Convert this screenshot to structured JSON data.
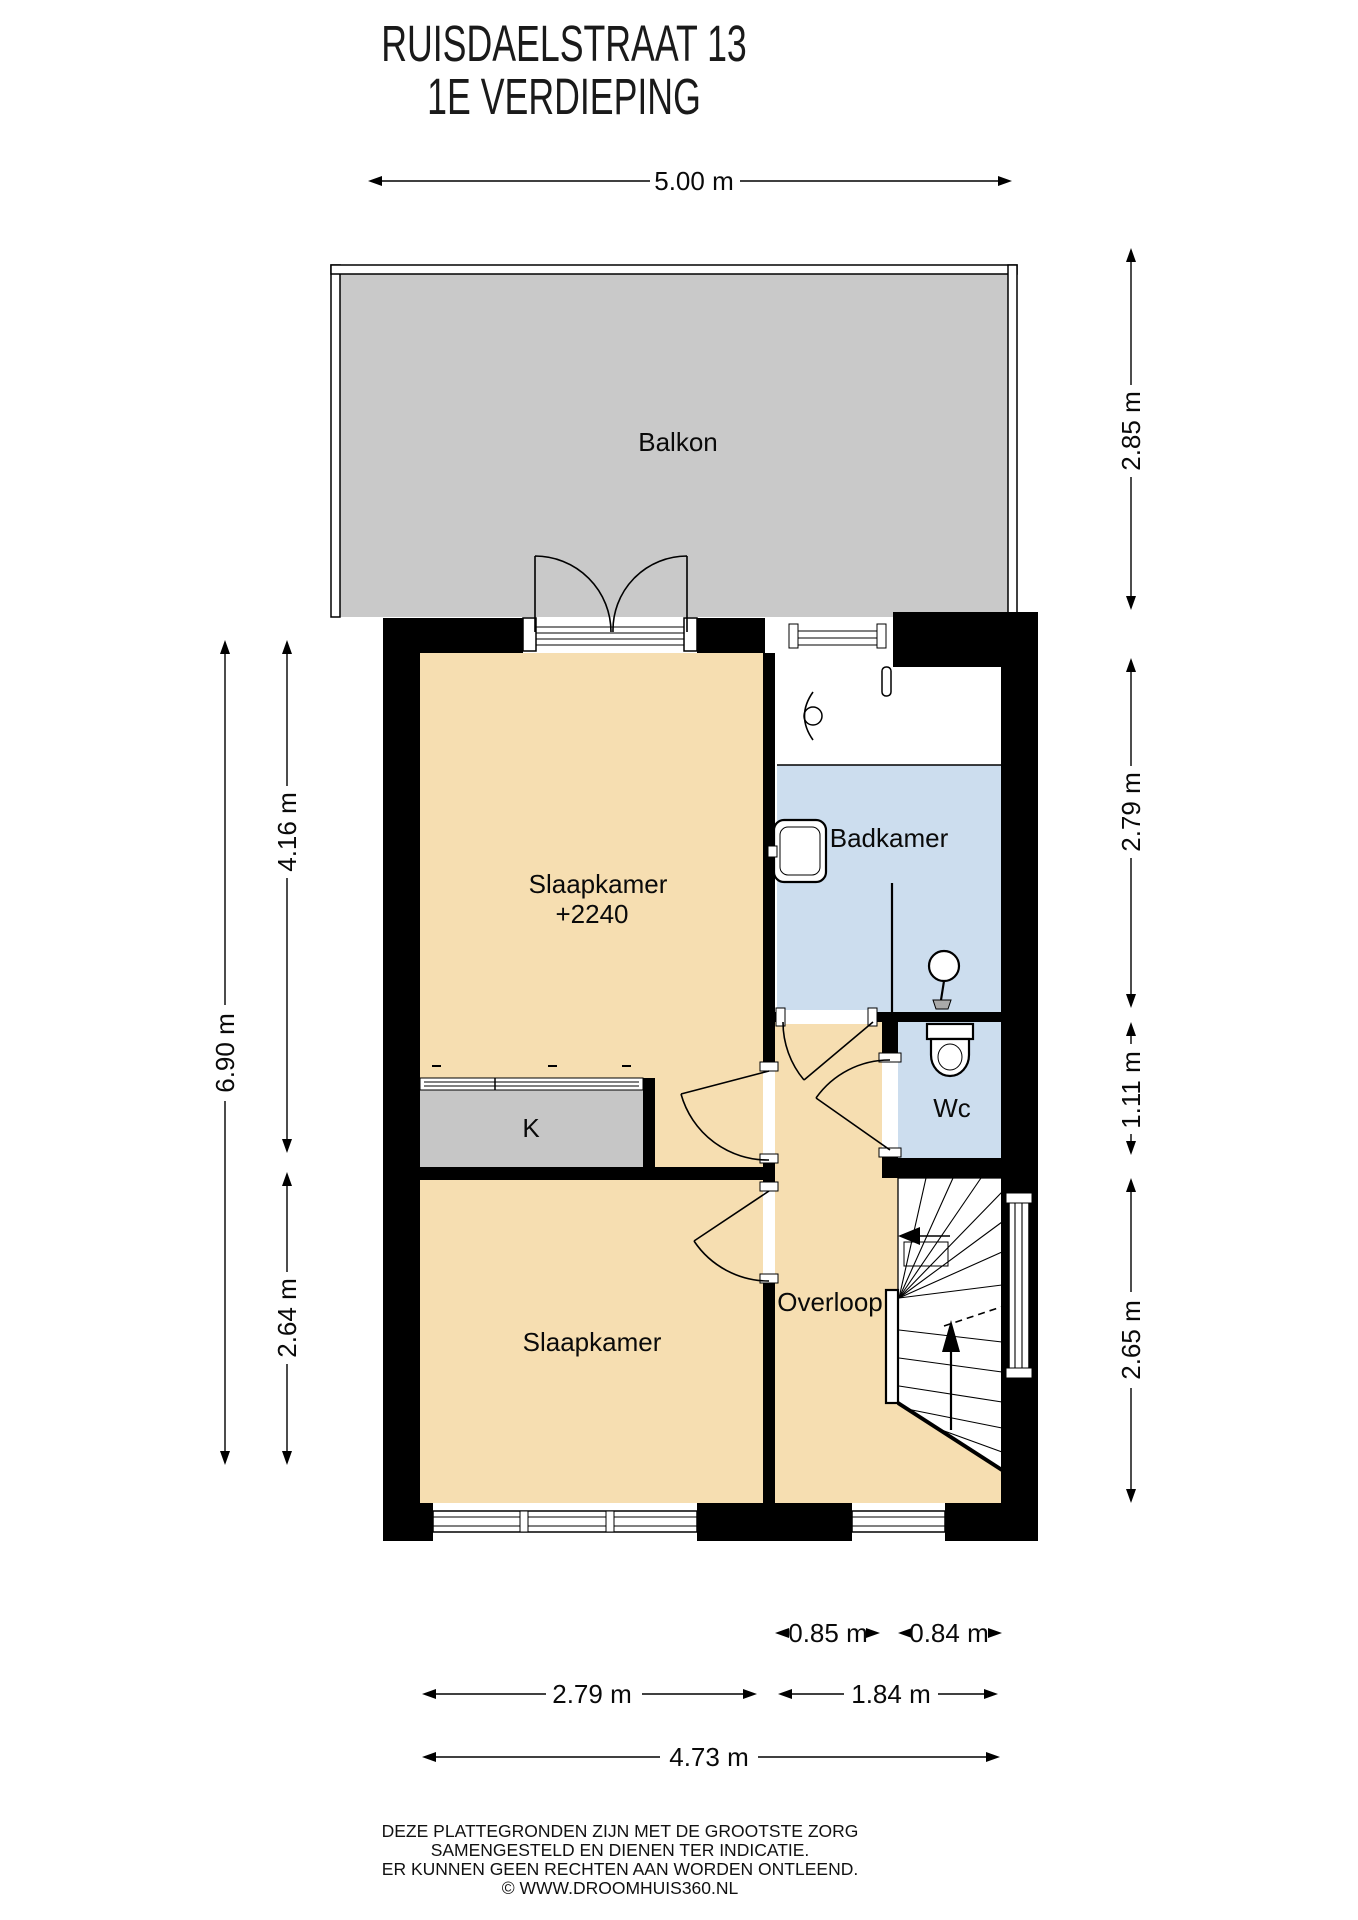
{
  "title": {
    "line1": "RUISDAELSTRAAT 13",
    "line2": "1E VERDIEPING"
  },
  "rooms": {
    "balkon": "Balkon",
    "slaapkamer1": "Slaapkamer",
    "slaapkamer1_level": "+2240",
    "badkamer": "Badkamer",
    "wc": "Wc",
    "closet": "K",
    "overloop": "Overloop",
    "slaapkamer2": "Slaapkamer"
  },
  "dimensions": {
    "top_width": "5.00 m",
    "left_total": "6.90 m",
    "left_upper": "4.16 m",
    "left_lower": "2.64 m",
    "right_balkon": "2.85 m",
    "right_badkamer": "2.79 m",
    "right_wc": "1.11 m",
    "right_stairs": "2.65 m",
    "bottom_overloop": "0.85 m",
    "bottom_stairs": "0.84 m",
    "bottom_slaapkamer": "2.79 m",
    "bottom_hal": "1.84 m",
    "bottom_total": "4.73 m"
  },
  "footer": {
    "line1": "DEZE PLATTEGRONDEN ZIJN MET DE GROOTSTE ZORG",
    "line2": "SAMENGESTELD EN DIENEN TER INDICATIE.",
    "line3": "ER KUNNEN GEEN RECHTEN AAN WORDEN ONTLEEND.",
    "line4": "© WWW.DROOMHUIS360.NL"
  },
  "colors": {
    "floor": "#f6deb1",
    "balcony": "#c9c9c9",
    "wet": "#ccddee",
    "closet": "#c6c6c6",
    "wall": "#000000"
  }
}
